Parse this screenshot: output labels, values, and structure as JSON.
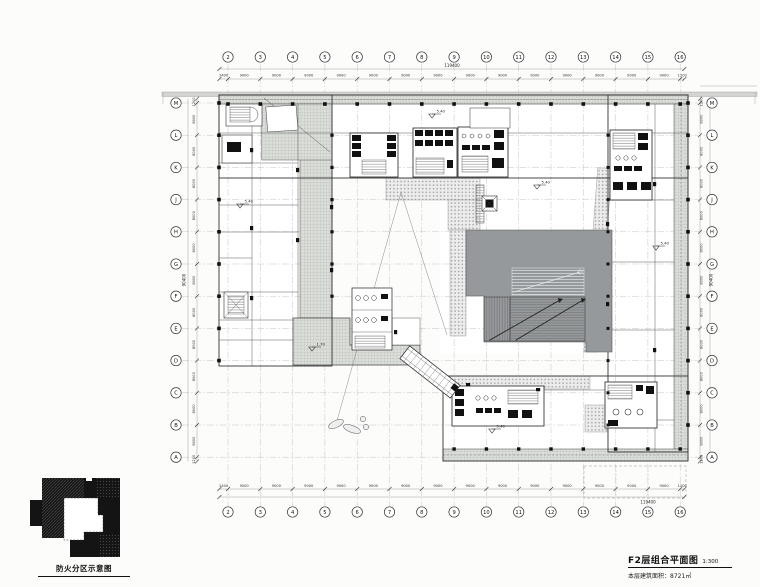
{
  "title_block": {
    "title": "F2层组合平面图",
    "scale": "1:300",
    "area": "本层建筑面积：8721㎡"
  },
  "inset": {
    "label": "防火分区示意图"
  },
  "grid": {
    "columns": [
      "2",
      "3",
      "4",
      "5",
      "6",
      "7",
      "8",
      "9",
      "10",
      "11",
      "12",
      "13",
      "14",
      "15",
      "16"
    ],
    "rows": [
      "M",
      "L",
      "K",
      "J",
      "H",
      "G",
      "F",
      "E",
      "D",
      "C",
      "B",
      "A"
    ],
    "col_spacings": [
      "9000",
      "9000",
      "9000",
      "9000",
      "9000",
      "9000",
      "9000",
      "9000",
      "9000",
      "9000",
      "9000",
      "9000",
      "9000",
      "9000"
    ],
    "row_spacings": [
      "8000",
      "8000",
      "8000",
      "8000",
      "8000",
      "8000",
      "8000",
      "8000",
      "8000",
      "8000",
      "8000"
    ],
    "edge_left": "2400",
    "edge_right": "1200",
    "edge_top": "1200",
    "edge_bottom": "1200",
    "total_width": "119400",
    "total_height": "90400"
  },
  "level_markers": [
    "5.40",
    "5.40",
    "5.40",
    "1.70",
    "5.40",
    "5.40"
  ],
  "colors": {
    "atrium_grey": "#95999b",
    "hatch_grey": "#dbded9",
    "paving_grey": "#ececec",
    "line_dark": "#222222"
  }
}
